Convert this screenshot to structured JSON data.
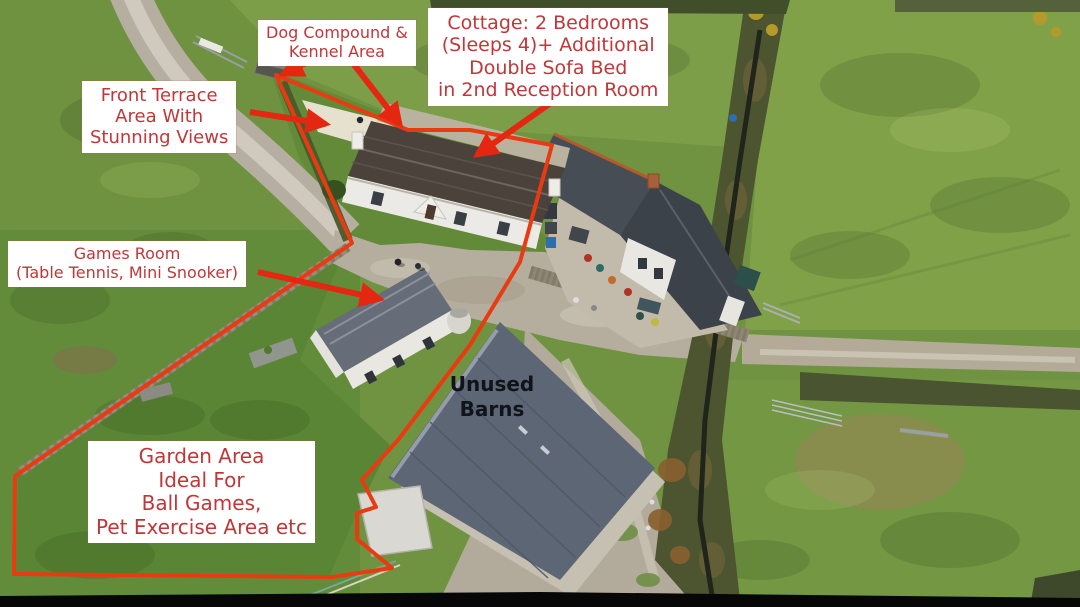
{
  "annotations": {
    "dog_compound": {
      "lines": [
        "Dog Compound &",
        "Kennel Area"
      ]
    },
    "cottage": {
      "lines": [
        "Cottage: 2 Bedrooms",
        "(Sleeps 4)+ Additional",
        "Double Sofa Bed",
        "in 2nd Reception Room"
      ]
    },
    "front_terrace": {
      "lines": [
        "Front Terrace",
        "Area With",
        "Stunning Views"
      ]
    },
    "games_room": {
      "lines": [
        "Games Room",
        "(Table Tennis, Mini Snooker)"
      ]
    },
    "garden_area": {
      "lines": [
        "Garden Area",
        "Ideal For",
        "Ball Games,",
        "Pet Exercise Area etc"
      ]
    },
    "unused_barns": {
      "lines": [
        "Unused",
        "Barns"
      ]
    }
  },
  "colors": {
    "annotation_text": "#c23638",
    "annotation_bg": "#ffffff",
    "arrow_red": "#e52611",
    "boundary_red": "#ea3a12",
    "barn_text": "#10131a"
  }
}
